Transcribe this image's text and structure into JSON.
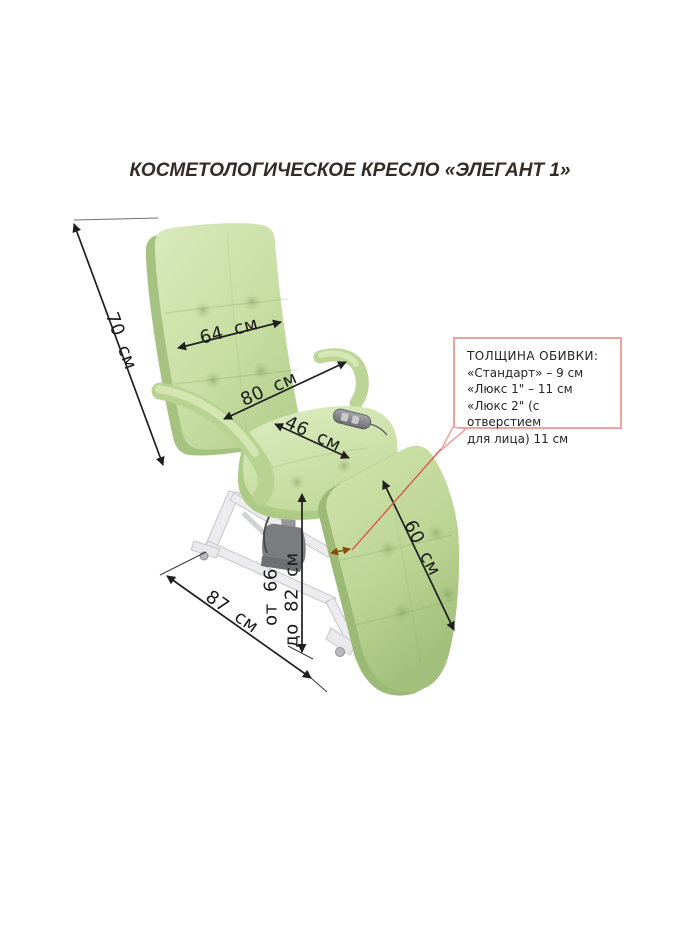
{
  "title": "КОСМЕТОЛОГИЧЕСКОЕ КРЕСЛО «ЭЛЕГАНТ 1»",
  "labels": {
    "backrest_height": "70 см",
    "backrest_width": "64 см",
    "overall_width": "80 см",
    "seat_width": "46 см",
    "legrest_length": "60 см",
    "base_length": "87 см",
    "height_min": "от 66",
    "height_max": "до 82 см"
  },
  "callout": {
    "heading": "ТОЛЩИНА ОБИВКИ:",
    "lines": [
      "«Стандарт» – 9 см",
      "«Люкс 1\" – 11 см",
      "«Люкс 2\" (с отверстием",
      "для лица) 11 см"
    ]
  },
  "colors": {
    "upholstery_green": "#c9dfa4",
    "frame_white": "#ececee",
    "dimension_line": "#1f1f1f",
    "callout_border": "#f0a39c",
    "leader_red": "#d9604f",
    "thickness_arrow_brown": "#8a4a0a"
  }
}
